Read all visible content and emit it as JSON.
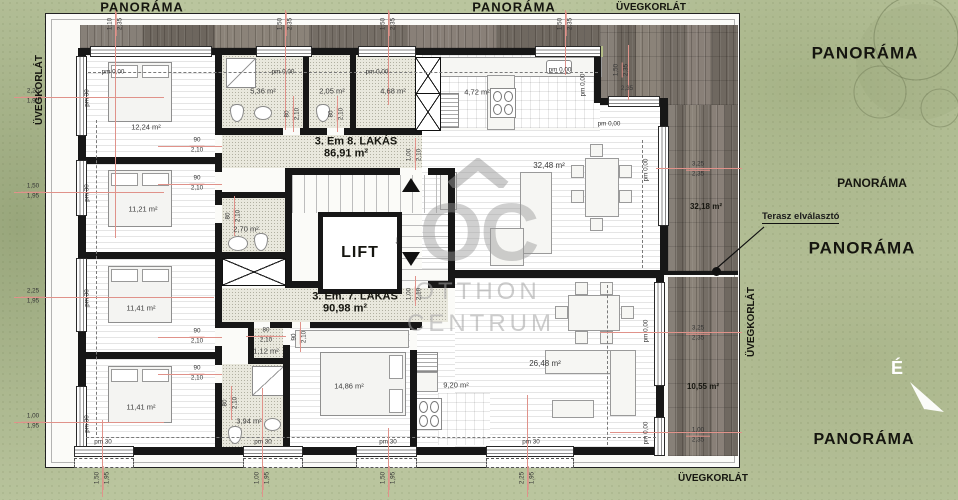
{
  "panorama": {
    "top_left": "PANORÁMA",
    "top_center": "PANORÁMA",
    "right_upper": "PANORÁMA",
    "right_small": "PANORÁMA",
    "right_middle": "PANORÁMA",
    "bottom_right": "PANORÁMA"
  },
  "glass_railing": {
    "left": "ÜVEGKORLÁT",
    "top": "ÜVEGKORLÁT",
    "right": "ÜVEGKORLÁT",
    "bottom": "ÜVEGKORLÁT"
  },
  "apartment8": {
    "name": "3. Em 8. LAKÁS",
    "area": "86,91 m²"
  },
  "apartment7": {
    "name": "3. Em. 7. LAKÁS",
    "area": "90,98 m²"
  },
  "lift": "LIFT",
  "north": "É",
  "terrace_divider": "Terasz elválasztó",
  "watermark": {
    "monogram": "OC",
    "line1": "OTTHON",
    "line2": "CENTRUM"
  },
  "rooms": {
    "r1": "12,24 m²",
    "r2": "11,21 m²",
    "r3": "11,41 m²",
    "r4": "11,41 m²",
    "bath8": "5,36 m²",
    "wc8": "2,05 m²",
    "hall8": "4,68 m²",
    "kitchen8": "4,72 m²",
    "living8": "32,48 m²",
    "bath8b": "2,70 m²",
    "terrace8": "32,18 m²",
    "storage7": "1,12 m²",
    "bath7": "3,94 m²",
    "bedroom7": "14,86 m²",
    "kitchen7": "9,20 m²",
    "living7": "26,48 m²",
    "terrace7": "10,55 m²"
  },
  "levels": {
    "zero": "pm 0,00",
    "plinth": "pm 30"
  },
  "dims": {
    "left1": {
      "a": "2,25",
      "b": "1,95"
    },
    "left2": {
      "a": "1,50",
      "b": "1,95"
    },
    "left3": {
      "a": "2,25",
      "b": "1,95"
    },
    "left4": {
      "a": "1,00",
      "b": "1,95"
    },
    "top1": {
      "a": "1,10",
      "b": "2,35"
    },
    "top2": {
      "a": "1,50",
      "b": "2,35"
    },
    "top3": {
      "a": "1,50",
      "b": "2,35"
    },
    "top4": {
      "a": "1,50",
      "b": "2,35"
    },
    "corner": {
      "a": "1,50",
      "b": "2,35"
    },
    "corner_w": "2,35",
    "right1": {
      "a": "3,25",
      "b": "2,35"
    },
    "right2": {
      "a": "3,25",
      "b": "2,35"
    },
    "right3": {
      "a": "1,00",
      "b": "2,35"
    },
    "bottom1": {
      "a": "1,50",
      "b": "1,95"
    },
    "bottom2": {
      "a": "1,00",
      "b": "1,95"
    },
    "bottom3": {
      "a": "1,50",
      "b": "1,95"
    },
    "bottom4": {
      "a": "2,25",
      "b": "1,95"
    },
    "door90": {
      "a": "90",
      "b": "2,10"
    },
    "door80": {
      "a": "80",
      "b": "2,10"
    },
    "door100": {
      "a": "1,00",
      "b": "2,10"
    },
    "lift_arrow": "↓"
  }
}
